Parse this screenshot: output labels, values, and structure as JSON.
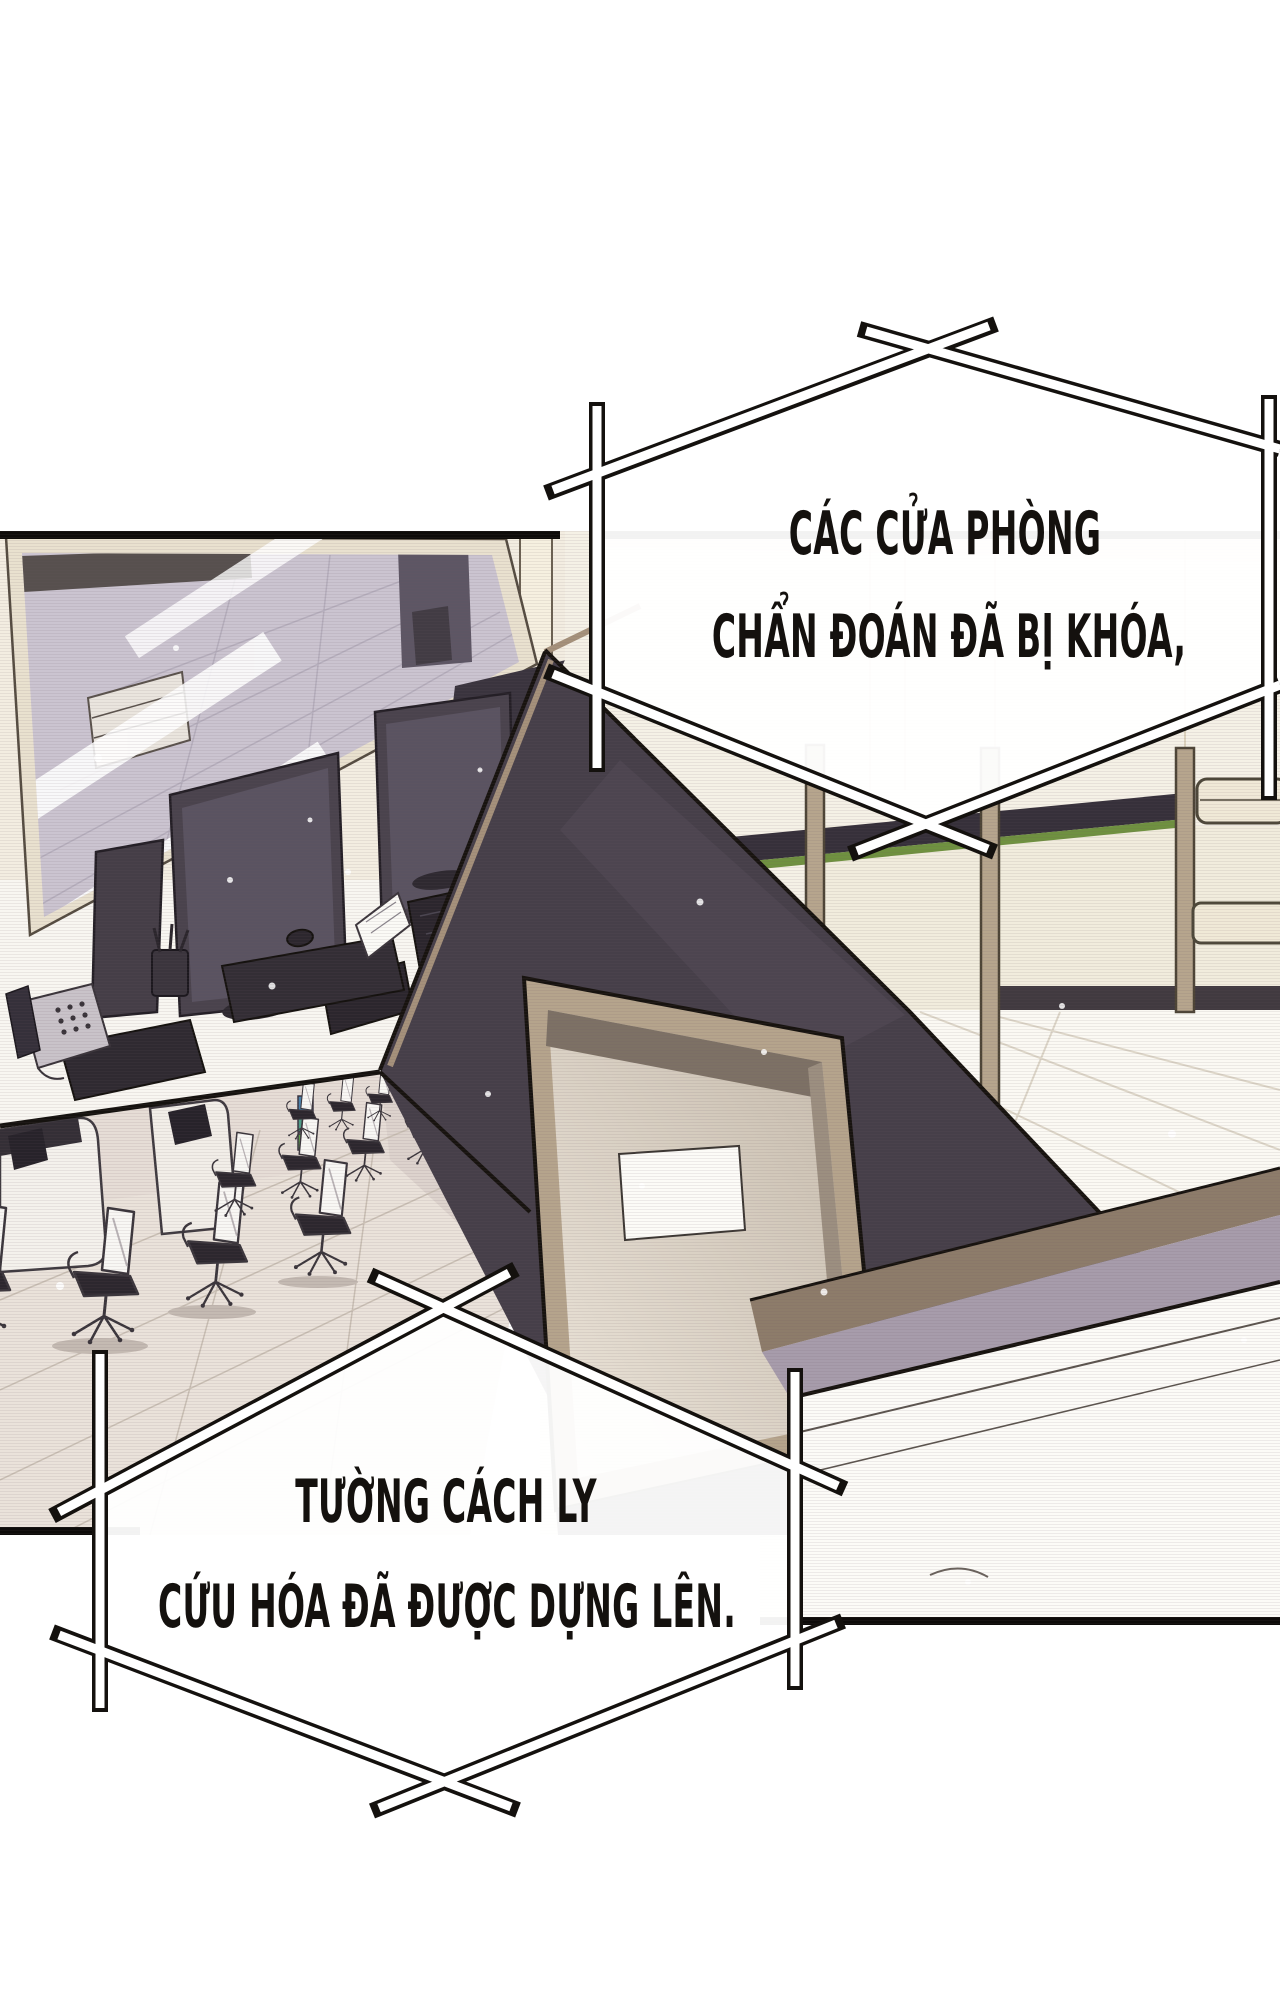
{
  "meta": {
    "type": "webtoon-comic-panel",
    "language": "vi"
  },
  "colors": {
    "ink": "#171310",
    "paper": "#ffffff",
    "caption_fill": "#ffffff",
    "art_cream": "#f5f1e6",
    "art_lavender_glass": "#cbc4d0",
    "art_dark_wedge": "#463f49",
    "art_door_tan": "#b5a48c",
    "art_green_accent": "#6f9140",
    "art_purple_shadow": "#a79cab"
  },
  "captions": {
    "top": {
      "line1": "CÁC CỬA PHÒNG",
      "line2": "CHẨN ĐOÁN ĐÃ BỊ KHÓA,"
    },
    "bottom": {
      "line1": "TƯỜNG CÁCH LY",
      "line2": "CỨU HÓA ĐÃ ĐƯỢC DỰNG LÊN."
    }
  }
}
